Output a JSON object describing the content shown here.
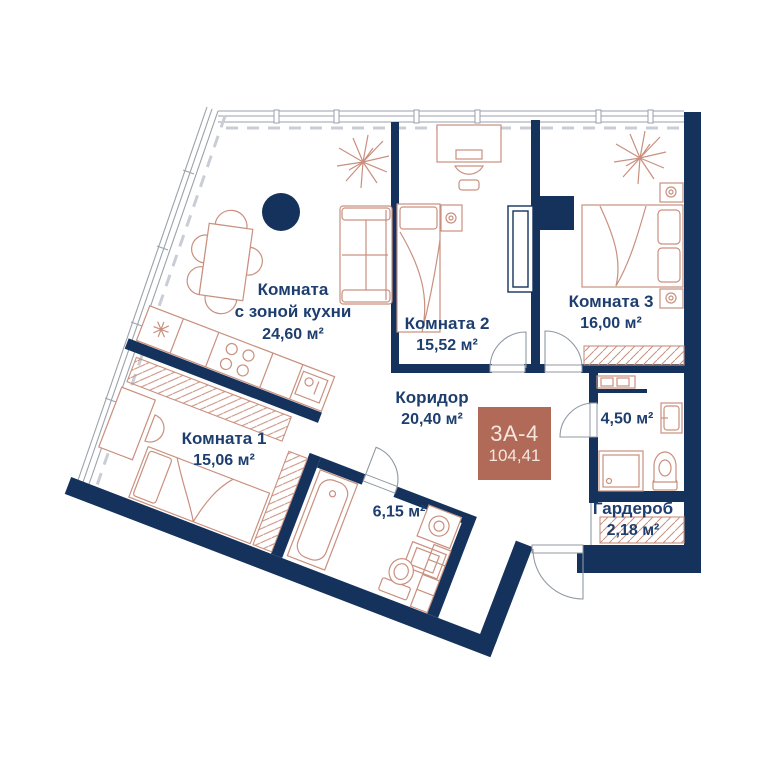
{
  "plan": {
    "badge": {
      "code": "3А-4",
      "total_area": "104,41",
      "bg": "#b26a58",
      "fg": "#f4e6df"
    },
    "rooms": [
      {
        "name": "Комната",
        "name2": "с зоной кухни",
        "area": "24,60 м²"
      },
      {
        "name": "Комната 2",
        "area": "15,52 м²"
      },
      {
        "name": "Комната 3",
        "area": "16,00 м²"
      },
      {
        "name": "Коридор",
        "area": "20,40 м²"
      },
      {
        "name": "Комната 1",
        "area": "15,06 м²"
      },
      {
        "area": "6,15 м²"
      },
      {
        "area": "4,50 м²"
      },
      {
        "name": "Гардероб",
        "area": "2,18 м²"
      }
    ],
    "colors": {
      "wall": "#14325c",
      "furniture": "#c9907f",
      "text": "#1d3e6e",
      "glazing": "#9aa2ac",
      "badge_bg": "#b26a58",
      "badge_fg": "#f4e6df"
    }
  }
}
